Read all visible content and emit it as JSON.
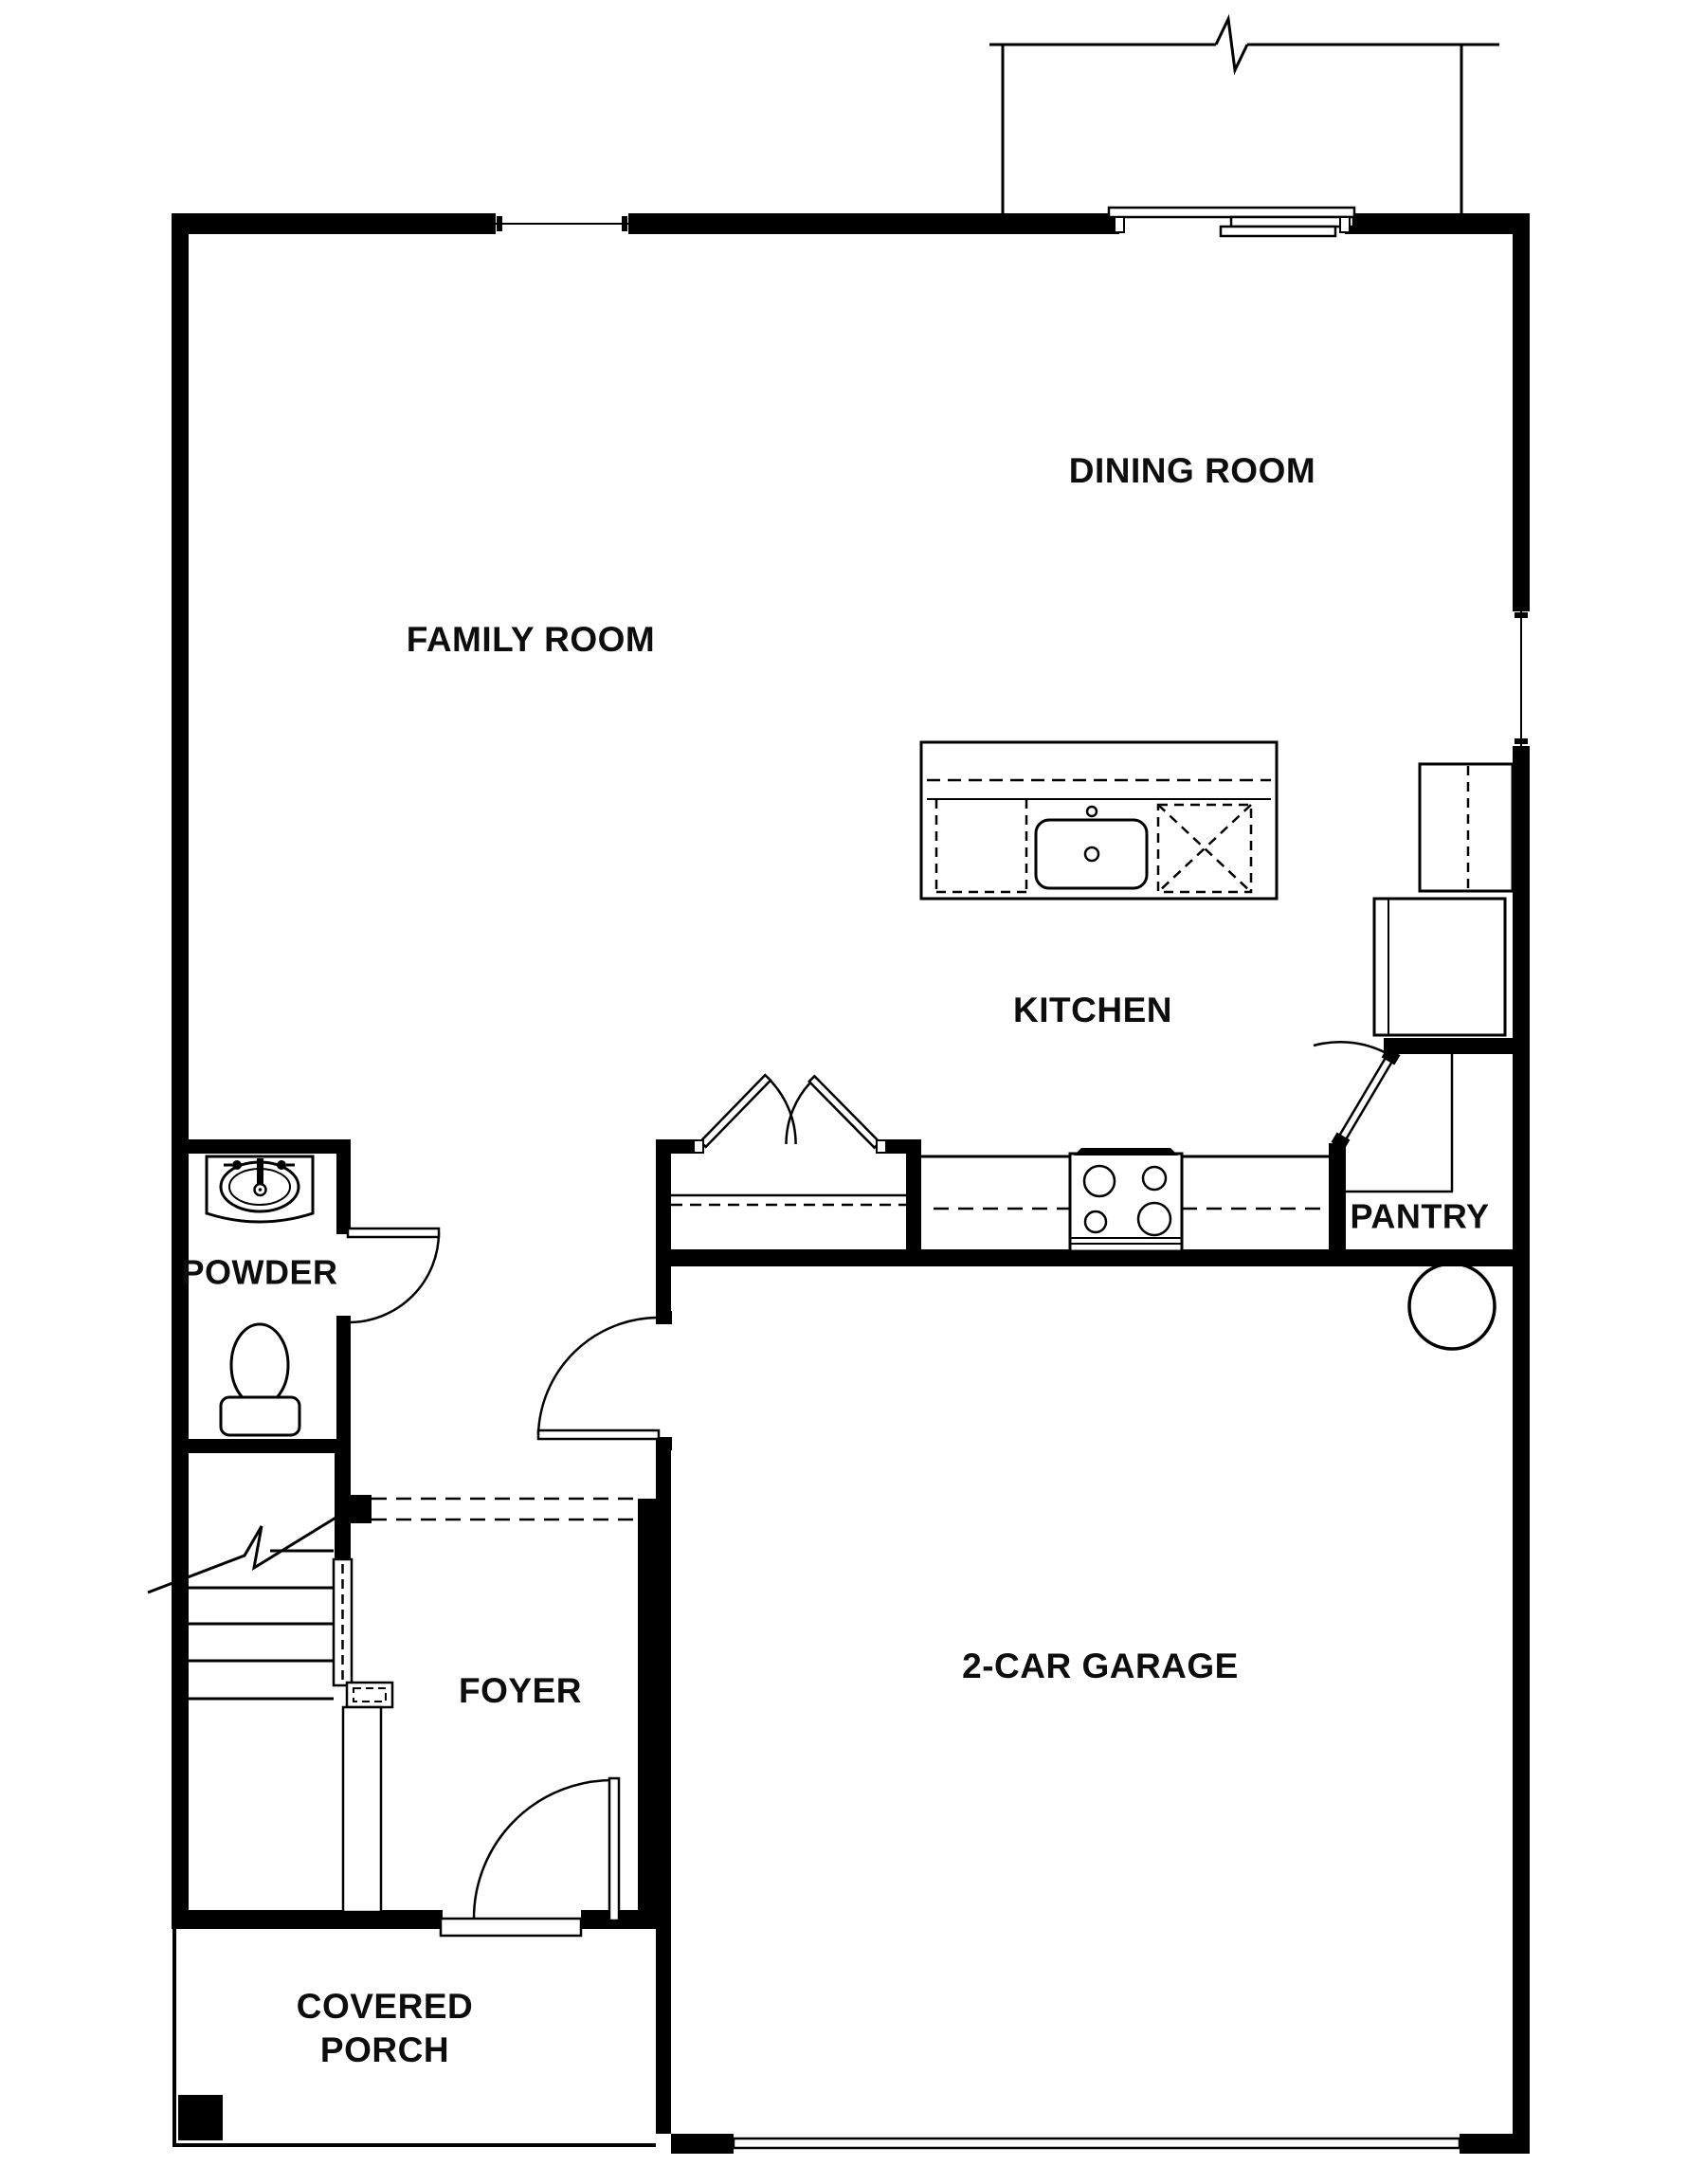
{
  "plan": {
    "rooms": {
      "family_room": "FAMILY ROOM",
      "dining_room": "DINING ROOM",
      "kitchen": "KITCHEN",
      "pantry": "PANTRY",
      "powder": "POWDER",
      "foyer": "FOYER",
      "garage": "2-CAR GARAGE",
      "covered_porch_line1": "COVERED",
      "covered_porch_line2": "PORCH"
    },
    "colors": {
      "wall": "#000000",
      "background": "#ffffff",
      "text": "#0d0d0d"
    }
  }
}
